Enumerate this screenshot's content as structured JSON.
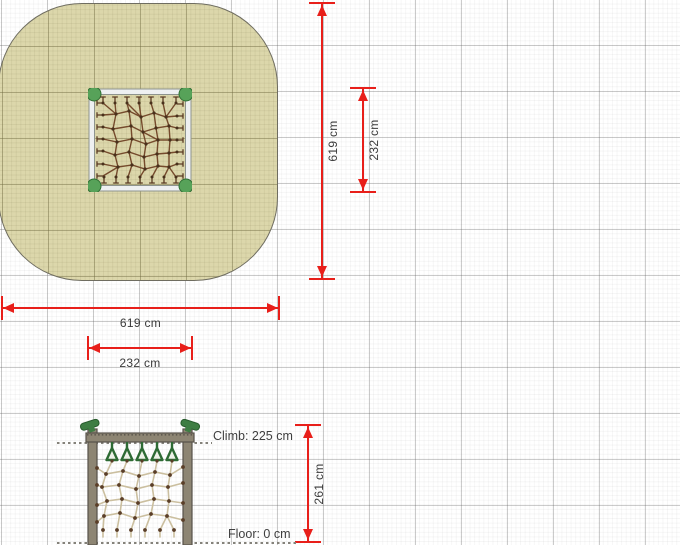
{
  "plan": {
    "zone_width_label": "619 cm",
    "zone_height_label": "619 cm",
    "net_width_label": "232 cm",
    "net_height_label": "232 cm"
  },
  "elevation": {
    "height_label": "261 cm",
    "climb_label": "Climb: 225 cm",
    "floor_label": "Floor: 0 cm"
  },
  "colors": {
    "dimension_red": "#e81f1a",
    "safety_zone_fill": "#dcd7ab",
    "frame_white": "#eef0f1",
    "plan_rope": "#754a2c",
    "elevation_rope": "#cbbf9f",
    "knot_brown": "#49311c",
    "wood_gray": "#8d8573",
    "accent_green": "#3e7d43"
  }
}
